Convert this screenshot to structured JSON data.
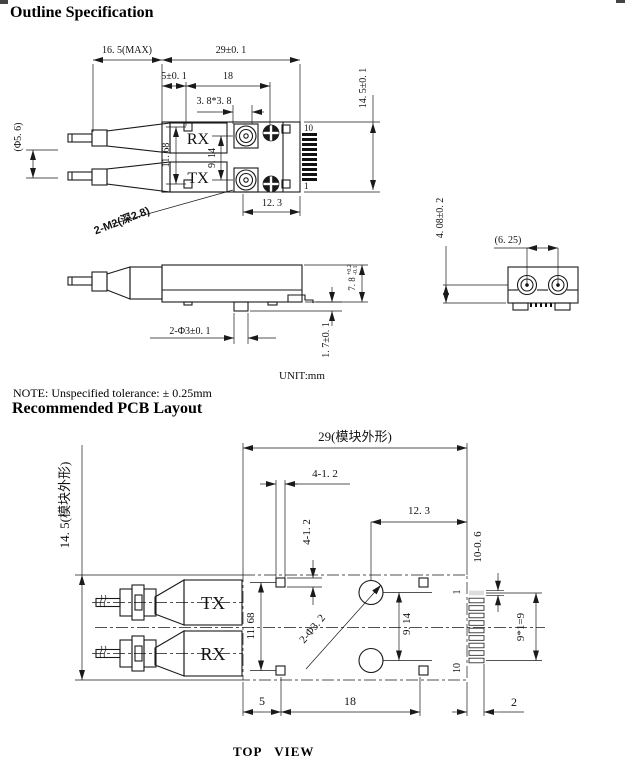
{
  "page": {
    "title": "Outline Specification",
    "note": "NOTE: Unspecified tolerance: ± 0.25mm",
    "pcb_title": "Recommended PCB Layout",
    "unit": "UNIT:mm",
    "bottom_caption": "TOP   VIEW"
  },
  "outline": {
    "top_view": {
      "dim_boot_len": "16. 5(MAX)",
      "dim_body_len": "29±0. 1",
      "dim_offset": "5±0. 1",
      "dim_inner_len": "18",
      "dim_boss": "3. 8*3. 8",
      "dim_height": "14. 5±0. 1",
      "dim_pads_v": "11. 68",
      "dim_ports_v": "9. 14",
      "dim_right": "12. 3",
      "dim_boot_dia": "(Φ5. 6)",
      "screw_note": "2-M2(深2.8)",
      "pin_top": "10",
      "pin_bottom": "1",
      "label_rx": "RX",
      "label_tx": "TX"
    },
    "side_view": {
      "dim_posts": "2-Φ3±0. 1",
      "dim_post_h": "1. 7±0. 1",
      "dim_body_h": "7. 8",
      "tol_plus": "+0.2",
      "tol_minus": "-0.1"
    },
    "end_view": {
      "dim_port_pitch": "(6. 25)",
      "dim_port_h": "4. 08±0. 2"
    }
  },
  "pcb": {
    "dim_width": "29(模块外形)",
    "dim_height": "14. 5(模块外形)",
    "dim_pad_w": "4-1. 2",
    "dim_pad_h": "4-1. 2",
    "dim_hole_edge": "12. 3",
    "dim_pin_pad": "10-0. 6",
    "dim_pin_pitch": "9*1=9",
    "dim_pads_v": "11. 68",
    "dim_holes_v": "9. 14",
    "holes_note": "2-Φ3. 2",
    "pin_first": "1",
    "pin_last": "10",
    "label_tx": "TX",
    "label_rx": "RX",
    "dim_left": "5",
    "dim_mid": "18",
    "dim_pad_out": "2"
  }
}
